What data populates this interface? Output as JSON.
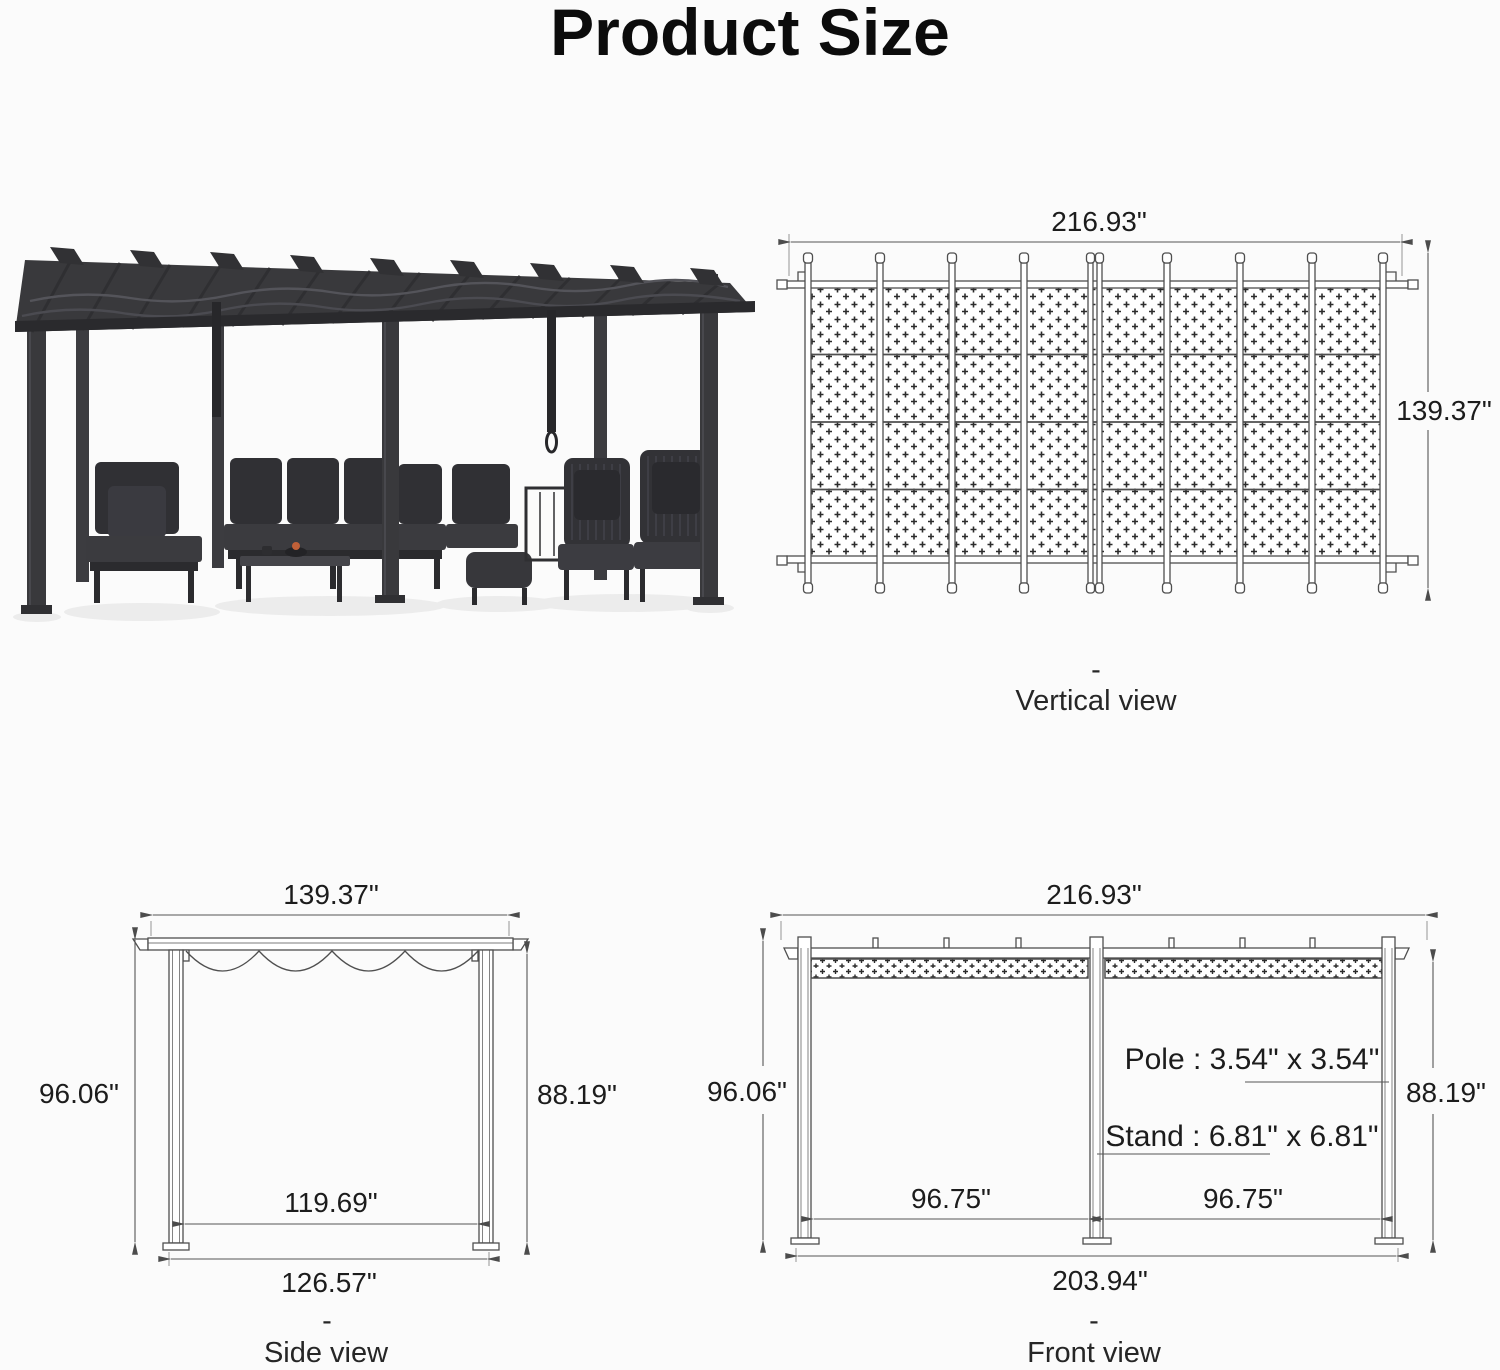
{
  "title": "Product Size",
  "colors": {
    "background": "#fbfbfb",
    "diagram_line": "#4f4f4f",
    "dimension_text": "#1c1c1c",
    "pergola_dark": "#39393c",
    "accent_flame": "#c06038"
  },
  "views": {
    "vertical": {
      "width": "216.93\"",
      "height": "139.37\"",
      "separator": "-",
      "caption": "Vertical view"
    },
    "side": {
      "top_width": "139.37\"",
      "left_height": "96.06\"",
      "right_height": "88.19\"",
      "inner_width": "119.69\"",
      "base_width": "126.57\"",
      "separator": "-",
      "caption": "Side view"
    },
    "front": {
      "top_width": "216.93\"",
      "left_height": "96.06\"",
      "right_height": "88.19\"",
      "pole_spec": "Pole : 3.54\" x 3.54\"",
      "stand_spec": "Stand : 6.81\" x 6.81\"",
      "left_bay": "96.75\"",
      "right_bay": "96.75\"",
      "base_width": "203.94\"",
      "separator": "-",
      "caption": "Front view"
    }
  }
}
